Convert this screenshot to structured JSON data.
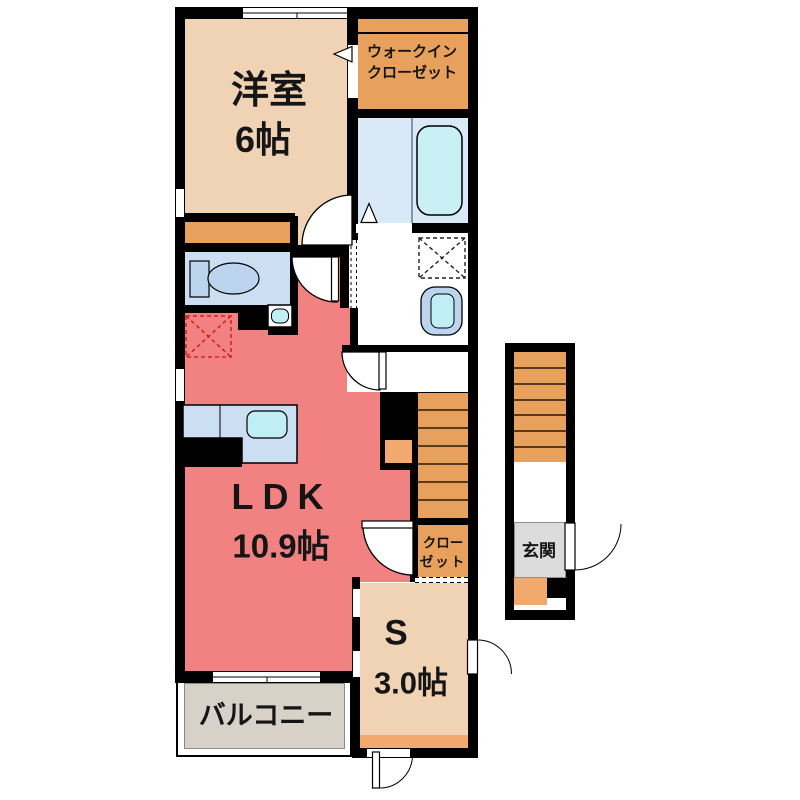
{
  "floorplan": {
    "rooms": {
      "western": {
        "label": "洋室",
        "size": "6帖"
      },
      "wic": {
        "line1": "ウォークイン",
        "line2": "クローゼット"
      },
      "ldk": {
        "label": "LDK",
        "size": "10.9帖"
      },
      "closet": {
        "line1": "クロー",
        "line2": "ゼット"
      },
      "service": {
        "label": "S",
        "size": "3.0帖"
      },
      "balcony": {
        "label": "バルコニー"
      },
      "entrance": {
        "label": "玄関"
      }
    },
    "colors": {
      "wall": "#000000",
      "tan": "#f0d3b5",
      "orange": "#e8a15c",
      "salmon": "#f28181",
      "kitchen_blue": "#cbdef2",
      "bath_blue": "#d9e9f8",
      "fixture_blue": "#bcd4ee",
      "sink_cyan": "#bfeef5",
      "tub_cyan": "#c9f0f4",
      "balcony_gray": "#d8d1c7",
      "genkan_gray": "#dcdcdc",
      "step_orange": "#f2a96e",
      "marker_red": "#cc2626"
    }
  }
}
